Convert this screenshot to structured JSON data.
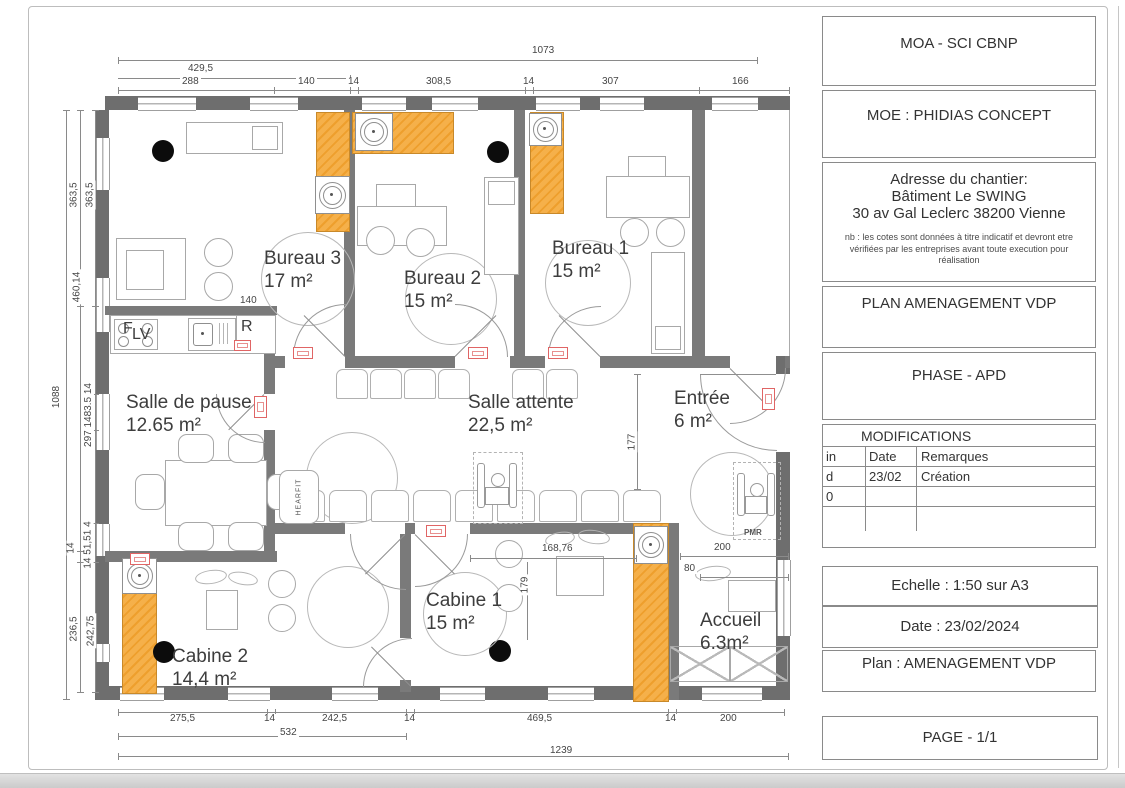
{
  "title_block": {
    "moa": "MOA - SCI CBNP",
    "moe": "MOE : PHIDIAS CONCEPT",
    "address_title": "Adresse du chantier:",
    "address_line1": "Bâtiment Le SWING",
    "address_line2": "30 av Gal Leclerc 38200 Vienne",
    "note": "nb : les cotes sont données à titre indicatif et devront etre vérifiées par les entreprises avant toute execution pour réalisation",
    "plan_title": "PLAN AMENAGEMENT VDP",
    "phase": "PHASE - APD",
    "modifications": {
      "title": "MODIFICATIONS",
      "col1_header": "in",
      "col2_header": "Date",
      "col3_header": "Remarques",
      "rows": [
        [
          "d",
          "23/02",
          "Création"
        ],
        [
          "0",
          "",
          ""
        ],
        [
          "",
          "",
          ""
        ]
      ]
    },
    "scale": "Echelle : 1:50 sur A3",
    "date": "Date : 23/02/2024",
    "plan_name": "Plan : AMENAGEMENT VDP",
    "page": "PAGE - 1/1"
  },
  "rooms": [
    {
      "name": "Bureau 3",
      "area": "17 m²"
    },
    {
      "name": "Bureau  2",
      "area": "15 m²"
    },
    {
      "name": "Bureau  1",
      "area": "15 m²"
    },
    {
      "name": "Salle de pause",
      "area": "12.65 m²"
    },
    {
      "name": "Salle  attente",
      "area": "22,5 m²"
    },
    {
      "name": "Entrée",
      "area": "6 m²"
    },
    {
      "name": "Cabine 1",
      "area": "15 m²"
    },
    {
      "name": "Cabine 2",
      "area": "14,4 m²"
    },
    {
      "name": "Accueil",
      "area": "6.3m²"
    }
  ],
  "equipment": {
    "f_label": "F",
    "lv_label": "LV",
    "fridge_label": "R",
    "hearfit_label": "HEARFIT",
    "pmr_label": "PMR"
  },
  "dims": {
    "d1073": "1073",
    "d429": "429,5",
    "d288": "288",
    "d140a": "140",
    "d14a": "14",
    "d308": "308,5",
    "d14b": "14",
    "d307": "307",
    "d166": "166",
    "d1088": "1088",
    "d363a": "363,5",
    "d363b": "363,5",
    "d460": "460,14",
    "dchainL": "297 1483.5 14",
    "d14c": "14",
    "dchainL2": "14 51,51 4",
    "d236": "236,5",
    "d242b": "242,75",
    "d275": "275,5",
    "d14d": "14",
    "d2425": "242,5",
    "d14e": "14",
    "d469": "469,5",
    "d14f": "14",
    "d200a": "200",
    "d532": "532",
    "d1239": "1239",
    "d140k": "140",
    "d177": "177",
    "d16876": "168,76",
    "d179": "179",
    "d200b": "200",
    "d80": "80"
  },
  "colors": {
    "wall": "#6e6e6e",
    "cabinet": "#f5b04a",
    "tag_red": "#e06565"
  }
}
